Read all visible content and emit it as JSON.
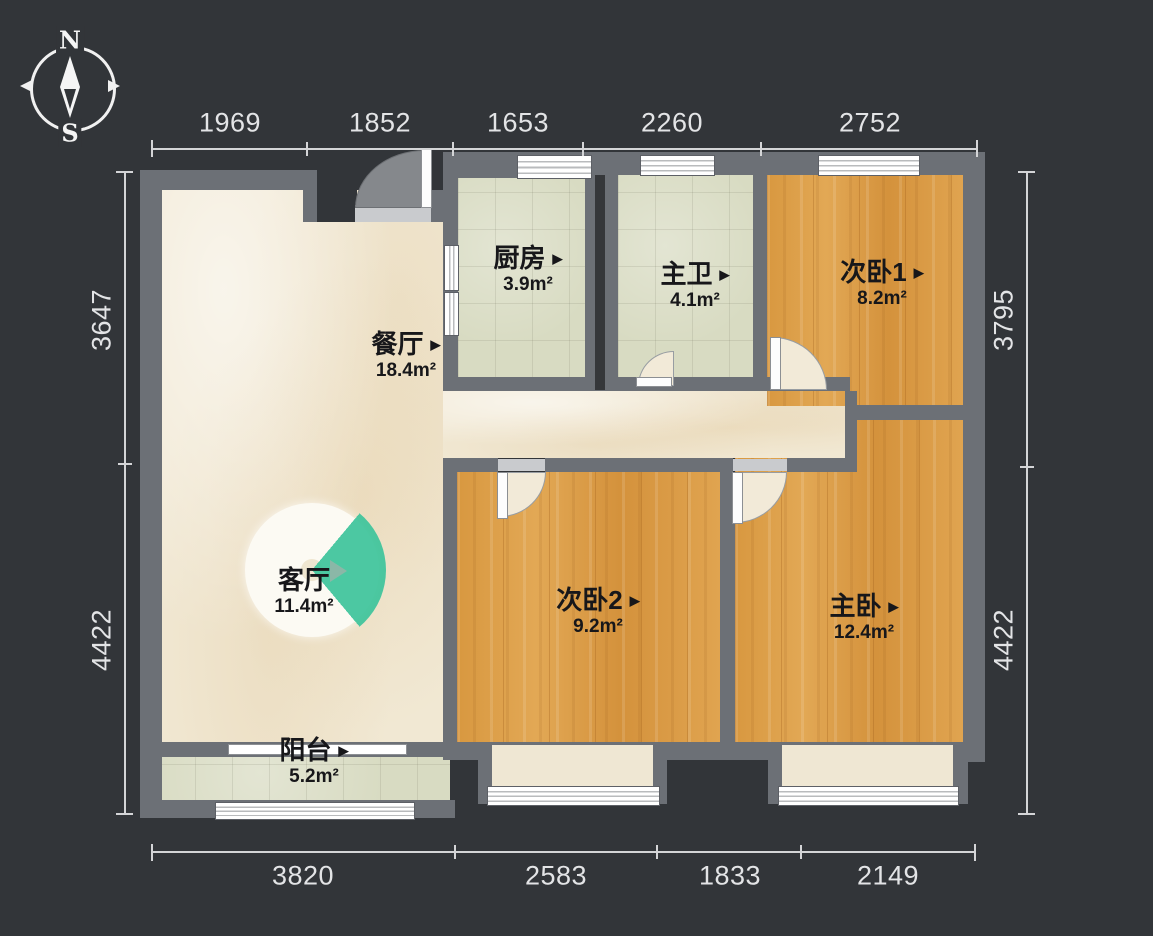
{
  "title": "apartment-floor-plan",
  "compass": {
    "north": "N",
    "south": "S"
  },
  "ui": {
    "label_marker": "▶"
  },
  "rooms": [
    {
      "id": "kitchen",
      "name": "厨房",
      "area": "3.9m²"
    },
    {
      "id": "master-bath",
      "name": "主卫",
      "area": "4.1m²"
    },
    {
      "id": "second-bedroom-1",
      "name": "次卧1",
      "area": "8.2m²"
    },
    {
      "id": "dining-room",
      "name": "餐厅",
      "area": "18.4m²"
    },
    {
      "id": "living-room",
      "name": "客厅",
      "area": "11.4m²"
    },
    {
      "id": "second-bedroom-2",
      "name": "次卧2",
      "area": "9.2m²"
    },
    {
      "id": "master-bedroom",
      "name": "主卧",
      "area": "12.4m²"
    },
    {
      "id": "balcony",
      "name": "阳台",
      "area": "5.2m²"
    }
  ],
  "dimensions": {
    "top": [
      "1969",
      "1852",
      "1653",
      "2260",
      "2752"
    ],
    "bottom": [
      "3820",
      "2583",
      "1833",
      "2149"
    ],
    "left": [
      "3647",
      "4422"
    ],
    "right": [
      "3795",
      "4422"
    ]
  },
  "colors": {
    "background": "#323539",
    "wall": "#6c7076",
    "wood_floor": "#dca04e",
    "tile_floor": "#d8dbc2",
    "marble_floor": "#f1e8d3",
    "accent_teal": "#3dc49b",
    "dimension_text": "#e3e4e6"
  }
}
